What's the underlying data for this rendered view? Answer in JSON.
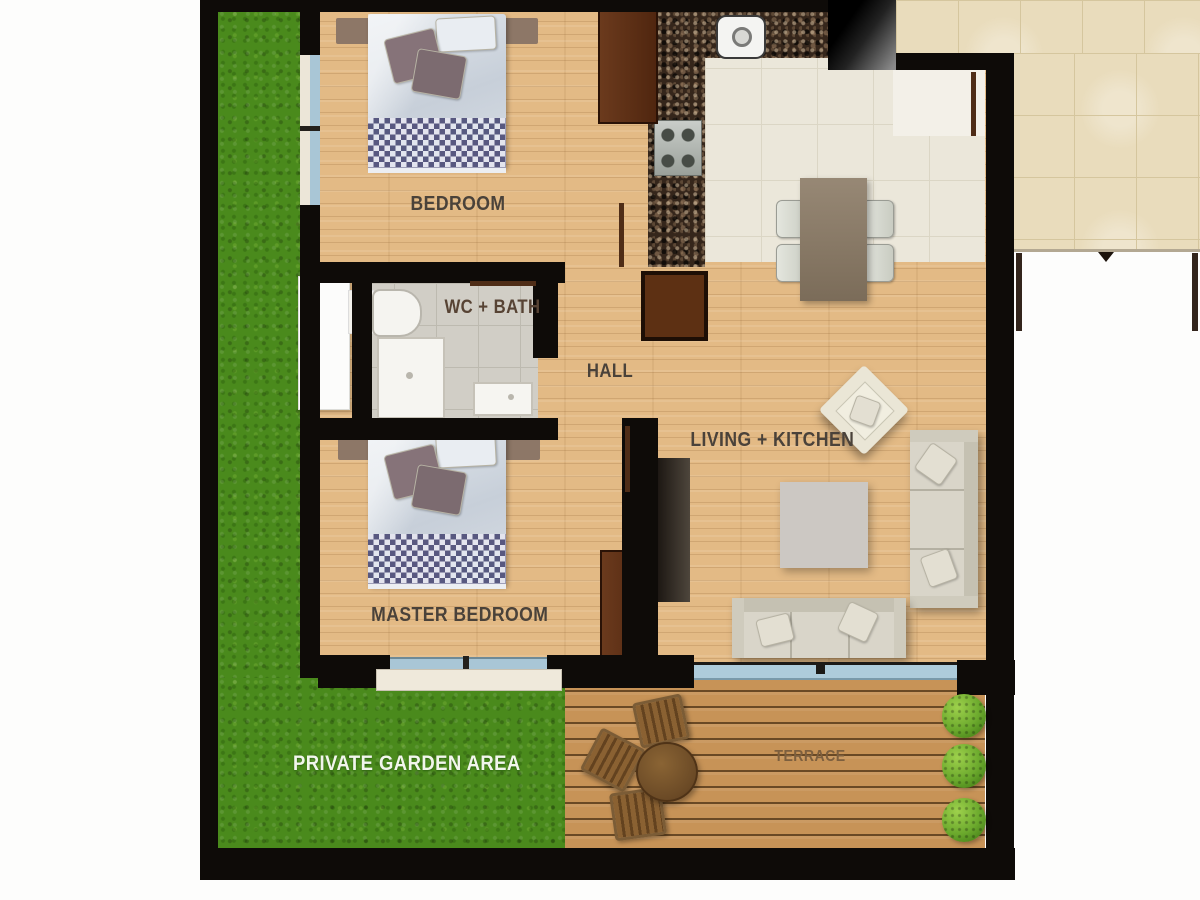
{
  "rooms": {
    "bedroom": {
      "label": "BEDROOM"
    },
    "wc_bath": {
      "label": "WC + BATH"
    },
    "hall": {
      "label": "HALL"
    },
    "living_kitchen": {
      "label": "LIVING + KITCHEN"
    },
    "master_bedroom": {
      "label": "MASTER BEDROOM"
    },
    "garden": {
      "label": "PRIVATE GARDEN AREA"
    },
    "terrace": {
      "label": "TERRACE"
    }
  },
  "colors": {
    "wall": "#0e0b08",
    "wood_floor": "#e3ba85",
    "kitchen_tile": "#ebe7da",
    "bath_tile": "#d1cec6",
    "communal_tile": "#e9dcbc",
    "grass": "#4a8a1c",
    "terrace_deck": "#c79357",
    "window_glass": "#a9c6d6",
    "dark_furniture_wood": "#5e2f16",
    "sofa_fabric": "#d9d5c9",
    "room_label_text": "#4a423a",
    "garden_label_text": "#f2f6ec",
    "terrace_label_text": "#7d5f3e"
  }
}
